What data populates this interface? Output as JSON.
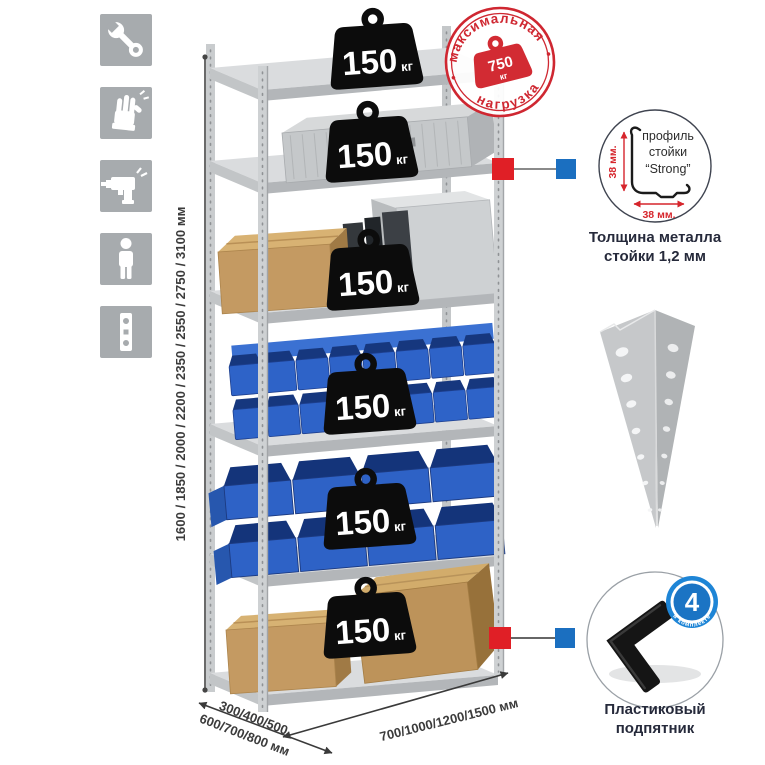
{
  "sidebar": {
    "icons": [
      {
        "name": "wrench-icon"
      },
      {
        "name": "gloves-icon"
      },
      {
        "name": "drill-icon"
      },
      {
        "name": "person-icon"
      },
      {
        "name": "level-icon"
      }
    ]
  },
  "dimensions": {
    "height_label": "1600 / 1850 / 2000 / 2200 / 2350 / 2550 / 2750 / 3100 мм",
    "depth_label_line1": "300/400/500",
    "depth_label_line2": "600/700/800 мм",
    "width_label": "700/1000/1200/1500 мм"
  },
  "rack": {
    "shelf_loads": [
      {
        "value": "150",
        "unit": "кг"
      },
      {
        "value": "150",
        "unit": "кг"
      },
      {
        "value": "150",
        "unit": "кг"
      },
      {
        "value": "150",
        "unit": "кг"
      },
      {
        "value": "150",
        "unit": "кг"
      },
      {
        "value": "150",
        "unit": "кг"
      }
    ]
  },
  "stamp": {
    "arc_top": "максимальная",
    "arc_bottom": "нагрузка",
    "weight_value": "750",
    "weight_unit": "кг"
  },
  "profile_detail": {
    "line1": "профиль",
    "line2": "стойки",
    "line3": "“Strong”",
    "vertical_dim": "38 мм.",
    "horizontal_dim": "38 мм.",
    "caption_line1": "Толщина металла",
    "caption_line2": "стойки 1,2 мм"
  },
  "foot_detail": {
    "badge_count": "4",
    "badge_arc": "в комплекте",
    "caption_line1": "Пластиковый",
    "caption_line2": "подпятник"
  },
  "colors": {
    "stamp_red": "#cf2731",
    "marker_red": "#e01f26",
    "marker_blue": "#1b6fc0",
    "bin_blue": "#2e62c6",
    "caption_navy": "#262a3b",
    "icon_gray": "#a7abae"
  }
}
